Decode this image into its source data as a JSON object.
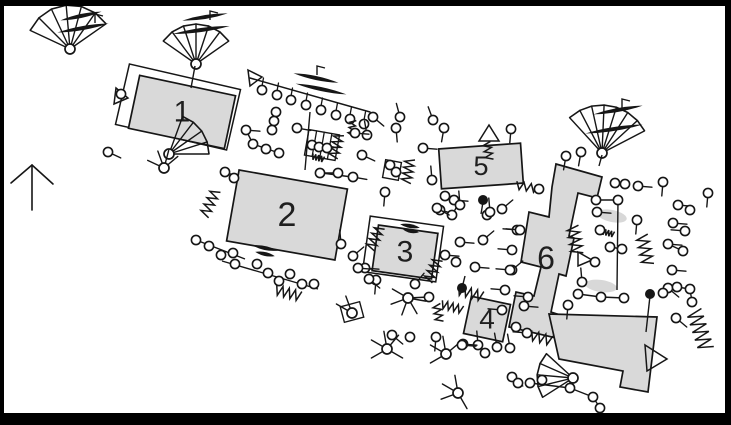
{
  "figure": {
    "kind": "archaeological-site-plan",
    "background": "#ffffff",
    "line_color": "#161616",
    "building_fill": "#d9d9d9",
    "building_stroke": "#161616",
    "blob_fill": "#d6d6d6",
    "frame_color": "#000000",
    "width": 731,
    "height": 425
  },
  "buildings": [
    {
      "label": "1",
      "cx": 182,
      "cy": 112,
      "w": 98,
      "h": 54,
      "rot": 12,
      "fs": 30
    },
    {
      "label": "2",
      "cx": 287,
      "cy": 215,
      "w": 110,
      "h": 72,
      "rot": 10,
      "fs": 34
    },
    {
      "label": "3",
      "cx": 405,
      "cy": 252,
      "w": 60,
      "h": 46,
      "rot": 8,
      "fs": 30
    },
    {
      "label": "4",
      "cx": 487,
      "cy": 319,
      "w": 40,
      "h": 38,
      "rot": 12,
      "fs": 28
    },
    {
      "label": "5",
      "cx": 481,
      "cy": 166,
      "w": 82,
      "h": 40,
      "rot": -4,
      "fs": 27
    }
  ],
  "building6": {
    "label": "6",
    "label_x": 546,
    "label_y": 258,
    "fs": 32,
    "strip": [
      [
        556,
        164
      ],
      [
        602,
        177
      ],
      [
        597,
        198
      ],
      [
        578,
        193
      ],
      [
        569,
        236
      ],
      [
        574,
        238
      ],
      [
        566,
        276
      ],
      [
        559,
        274
      ],
      [
        551,
        312
      ],
      [
        560,
        315
      ],
      [
        556,
        338
      ],
      [
        509,
        327
      ],
      [
        516,
        292
      ],
      [
        534,
        296
      ],
      [
        541,
        267
      ],
      [
        521,
        262
      ],
      [
        529,
        212
      ],
      [
        549,
        217
      ],
      [
        552,
        187
      ]
    ],
    "annex": [
      [
        549,
        314
      ],
      [
        657,
        317
      ],
      [
        648,
        392
      ],
      [
        620,
        387
      ],
      [
        623,
        371
      ],
      [
        559,
        359
      ]
    ]
  },
  "outlines": [
    {
      "cx": 178,
      "cy": 107,
      "w": 114,
      "h": 62,
      "rot": 13
    },
    {
      "cx": 403,
      "cy": 249,
      "w": 74,
      "h": 56,
      "rot": 8
    }
  ],
  "north_arrow": {
    "shaft": [
      [
        32,
        210
      ],
      [
        32,
        165
      ]
    ],
    "barbs": [
      [
        [
          32,
          165
        ],
        [
          11,
          183
        ]
      ],
      [
        [
          32,
          165
        ],
        [
          53,
          184
        ]
      ]
    ]
  },
  "fence": {
    "rail": [
      [
        250,
        78
      ],
      [
        370,
        112
      ]
    ],
    "circles": [
      [
        262,
        90
      ],
      [
        277,
        95
      ],
      [
        291,
        100
      ],
      [
        306,
        105
      ],
      [
        321,
        110
      ],
      [
        336,
        115
      ],
      [
        350,
        119
      ],
      [
        364,
        124
      ]
    ]
  },
  "trees": [
    {
      "x": 70,
      "y": 49,
      "dir": -95,
      "spread": 120,
      "r": 44,
      "n": 7
    },
    {
      "x": 196,
      "y": 64,
      "dir": -90,
      "spread": 110,
      "r": 40,
      "n": 7
    },
    {
      "x": 602,
      "y": 153,
      "dir": -80,
      "spread": 105,
      "r": 48,
      "n": 8
    },
    {
      "x": 573,
      "y": 378,
      "dir": 185,
      "spread": 75,
      "r": 36,
      "n": 5
    },
    {
      "x": 169,
      "y": 154,
      "dir": -35,
      "spread": 70,
      "r": 40,
      "n": 5
    }
  ],
  "blades": [
    [
      83,
      28,
      -10,
      52
    ],
    [
      81,
      16,
      -12,
      42
    ],
    [
      201,
      30,
      -8,
      58
    ],
    [
      205,
      17,
      -9,
      46
    ],
    [
      316,
      78,
      12,
      46
    ],
    [
      321,
      89,
      12,
      52
    ],
    [
      614,
      129,
      -9,
      58
    ],
    [
      618,
      110,
      -10,
      50
    ],
    [
      265,
      248,
      12,
      26
    ],
    [
      265,
      254,
      12,
      20
    ],
    [
      410,
      226,
      10,
      20
    ],
    [
      411,
      231,
      10,
      16
    ]
  ],
  "flags": [
    [
      95,
      14
    ],
    [
      210,
      11
    ],
    [
      317,
      66
    ],
    [
      622,
      99
    ]
  ],
  "triangles": [
    [
      [
        248,
        70
      ],
      [
        262,
        77
      ],
      [
        250,
        86
      ]
    ],
    [
      [
        479,
        141
      ],
      [
        499,
        141
      ],
      [
        489,
        125
      ]
    ],
    [
      [
        645,
        345
      ],
      [
        667,
        359
      ],
      [
        647,
        371
      ]
    ],
    [
      [
        116,
        88
      ],
      [
        128,
        98
      ],
      [
        114,
        104
      ]
    ],
    [
      [
        578,
        252
      ],
      [
        578,
        266
      ],
      [
        592,
        260
      ]
    ]
  ],
  "squares": [
    [
      392,
      170,
      16,
      18,
      10
    ],
    [
      352,
      312,
      20,
      16,
      -15
    ]
  ],
  "ladders": [
    [
      322,
      145,
      31,
      26,
      10
    ]
  ],
  "zigzags": [
    [
      210,
      203,
      115,
      14,
      5,
      4
    ],
    [
      336,
      146,
      105,
      12,
      5,
      4
    ],
    [
      408,
      171,
      100,
      12,
      5,
      4
    ],
    [
      375,
      238,
      115,
      12,
      5,
      4
    ],
    [
      433,
      270,
      115,
      12,
      5,
      4
    ],
    [
      470,
      293,
      15,
      13,
      5,
      4
    ],
    [
      452,
      307,
      15,
      11,
      4,
      4
    ],
    [
      438,
      313,
      80,
      9,
      4,
      3
    ],
    [
      527,
      187,
      10,
      11,
      4,
      3
    ],
    [
      575,
      240,
      80,
      14,
      6,
      4
    ],
    [
      645,
      250,
      78,
      15,
      6,
      4
    ],
    [
      700,
      330,
      72,
      20,
      8,
      5
    ],
    [
      288,
      293,
      15,
      13,
      5,
      4
    ],
    [
      541,
      338,
      15,
      11,
      5,
      3
    ],
    [
      318,
      158,
      15,
      6,
      3,
      4
    ],
    [
      608,
      233,
      15,
      6,
      3,
      4
    ],
    [
      488,
      151,
      80,
      9,
      4,
      3
    ],
    [
      352,
      128,
      100,
      8,
      3,
      3
    ]
  ],
  "spiders": [
    {
      "x": 164,
      "y": 168,
      "legs": [
        205,
        250,
        285,
        320
      ]
    },
    {
      "x": 408,
      "y": 298,
      "legs": [
        10,
        60,
        110,
        160,
        210
      ]
    },
    {
      "x": 352,
      "y": 313,
      "legs": [
        210,
        250
      ]
    },
    {
      "x": 387,
      "y": 349,
      "legs": [
        30,
        150,
        210,
        260,
        310
      ]
    },
    {
      "x": 446,
      "y": 354,
      "legs": [
        150,
        210,
        260,
        320
      ]
    },
    {
      "x": 458,
      "y": 393,
      "legs": [
        60,
        160,
        210,
        260
      ]
    }
  ],
  "dots": [
    [
      483,
      200
    ],
    [
      462,
      288
    ],
    [
      650,
      294
    ]
  ],
  "blobs": [
    [
      612,
      216,
      15,
      6,
      12
    ],
    [
      601,
      286,
      16,
      6,
      8
    ]
  ],
  "chains": [
    [
      [
        246,
        130
      ],
      [
        253,
        144
      ],
      [
        279,
        153
      ]
    ],
    [
      [
        276,
        108
      ],
      [
        271,
        134
      ]
    ],
    [
      [
        310,
        112
      ],
      [
        305,
        170
      ]
    ],
    [
      [
        196,
        240
      ],
      [
        245,
        259
      ]
    ],
    [
      [
        222,
        261
      ],
      [
        318,
        289
      ]
    ],
    [
      [
        322,
        173
      ],
      [
        352,
        177
      ]
    ],
    [
      [
        596,
        200
      ],
      [
        618,
        200
      ],
      [
        617,
        290
      ]
    ],
    [
      [
        610,
        247
      ],
      [
        622,
        249
      ]
    ],
    [
      [
        578,
        294
      ],
      [
        601,
        297
      ],
      [
        624,
        298
      ]
    ],
    [
      [
        663,
        293
      ],
      [
        677,
        287
      ],
      [
        690,
        289
      ],
      [
        692,
        302
      ]
    ],
    [
      [
        668,
        244
      ],
      [
        683,
        251
      ]
    ],
    [
      [
        530,
        383
      ],
      [
        570,
        388
      ],
      [
        593,
        397
      ],
      [
        600,
        408
      ]
    ],
    [
      [
        408,
        298
      ],
      [
        429,
        297
      ]
    ],
    [
      [
        602,
        155
      ],
      [
        599,
        166
      ]
    ],
    [
      [
        195,
        66
      ],
      [
        191,
        88
      ]
    ],
    [
      [
        650,
        296
      ],
      [
        646,
        332
      ]
    ],
    [
      [
        483,
        202
      ],
      [
        481,
        214
      ]
    ],
    [
      [
        462,
        288
      ],
      [
        465,
        276
      ]
    ]
  ],
  "pins": [
    [
      108,
      152,
      25
    ],
    [
      121,
      94,
      null
    ],
    [
      246,
      130,
      5
    ],
    [
      276,
      112,
      null
    ],
    [
      274,
      121,
      null
    ],
    [
      272,
      130,
      null
    ],
    [
      253,
      144,
      null
    ],
    [
      266,
      149,
      null
    ],
    [
      279,
      153,
      null
    ],
    [
      297,
      128,
      10
    ],
    [
      225,
      172,
      20
    ],
    [
      234,
      178,
      null
    ],
    [
      312,
      145,
      null
    ],
    [
      319,
      147,
      null
    ],
    [
      327,
      148,
      null
    ],
    [
      320,
      173,
      0
    ],
    [
      338,
      173,
      null
    ],
    [
      353,
      177,
      10
    ],
    [
      362,
      155,
      25
    ],
    [
      367,
      135,
      260
    ],
    [
      385,
      192,
      95
    ],
    [
      390,
      165,
      null
    ],
    [
      396,
      172,
      null
    ],
    [
      423,
      148,
      5
    ],
    [
      433,
      120,
      250
    ],
    [
      400,
      117,
      255
    ],
    [
      396,
      128,
      85
    ],
    [
      373,
      117,
      40
    ],
    [
      355,
      133,
      5
    ],
    [
      432,
      180,
      265
    ],
    [
      444,
      128,
      100
    ],
    [
      511,
      129,
      95
    ],
    [
      539,
      189,
      null
    ],
    [
      445,
      196,
      40
    ],
    [
      454,
      200,
      5
    ],
    [
      440,
      210,
      15
    ],
    [
      452,
      215,
      300
    ],
    [
      487,
      215,
      null
    ],
    [
      502,
      209,
      320
    ],
    [
      437,
      208,
      30
    ],
    [
      460,
      205,
      265
    ],
    [
      490,
      212,
      265
    ],
    [
      460,
      242,
      5
    ],
    [
      483,
      240,
      320
    ],
    [
      445,
      255,
      5
    ],
    [
      456,
      262,
      null
    ],
    [
      475,
      267,
      5
    ],
    [
      512,
      270,
      320
    ],
    [
      517,
      230,
      185
    ],
    [
      429,
      297,
      null
    ],
    [
      415,
      284,
      310
    ],
    [
      365,
      268,
      5
    ],
    [
      376,
      280,
      95
    ],
    [
      341,
      244,
      265
    ],
    [
      353,
      256,
      320
    ],
    [
      358,
      268,
      5
    ],
    [
      369,
      279,
      40
    ],
    [
      196,
      240,
      null
    ],
    [
      209,
      246,
      null
    ],
    [
      221,
      255,
      null
    ],
    [
      233,
      253,
      null
    ],
    [
      235,
      264,
      null
    ],
    [
      257,
      264,
      null
    ],
    [
      268,
      273,
      null
    ],
    [
      279,
      281,
      null
    ],
    [
      290,
      274,
      null
    ],
    [
      302,
      284,
      null
    ],
    [
      314,
      284,
      null
    ],
    [
      478,
      345,
      265
    ],
    [
      497,
      347,
      260
    ],
    [
      463,
      344,
      5
    ],
    [
      516,
      327,
      null
    ],
    [
      527,
      333,
      185
    ],
    [
      524,
      306,
      5
    ],
    [
      520,
      230,
      185
    ],
    [
      512,
      250,
      185
    ],
    [
      510,
      270,
      185
    ],
    [
      505,
      290,
      185
    ],
    [
      502,
      310,
      185
    ],
    [
      566,
      156,
      100
    ],
    [
      581,
      152,
      100
    ],
    [
      615,
      183,
      5
    ],
    [
      625,
      184,
      null
    ],
    [
      638,
      186,
      5
    ],
    [
      663,
      182,
      95
    ],
    [
      678,
      205,
      5
    ],
    [
      690,
      210,
      null
    ],
    [
      708,
      193,
      95
    ],
    [
      596,
      200,
      null
    ],
    [
      618,
      200,
      null
    ],
    [
      637,
      220,
      95
    ],
    [
      597,
      212,
      5
    ],
    [
      600,
      230,
      null
    ],
    [
      610,
      247,
      null
    ],
    [
      622,
      249,
      null
    ],
    [
      582,
      282,
      265
    ],
    [
      578,
      294,
      null
    ],
    [
      601,
      297,
      null
    ],
    [
      624,
      298,
      null
    ],
    [
      595,
      262,
      null
    ],
    [
      673,
      223,
      5
    ],
    [
      685,
      231,
      185
    ],
    [
      668,
      244,
      5
    ],
    [
      683,
      251,
      null
    ],
    [
      672,
      270,
      5
    ],
    [
      668,
      288,
      40
    ],
    [
      663,
      293,
      null
    ],
    [
      677,
      287,
      null
    ],
    [
      690,
      289,
      null
    ],
    [
      692,
      302,
      null
    ],
    [
      676,
      318,
      40
    ],
    [
      392,
      335,
      40
    ],
    [
      410,
      337,
      null
    ],
    [
      436,
      337,
      95
    ],
    [
      462,
      345,
      5
    ],
    [
      485,
      353,
      null
    ],
    [
      510,
      348,
      260
    ],
    [
      512,
      377,
      40
    ],
    [
      518,
      383,
      null
    ],
    [
      530,
      383,
      null
    ],
    [
      542,
      380,
      null
    ],
    [
      570,
      388,
      null
    ],
    [
      593,
      397,
      null
    ],
    [
      600,
      408,
      null
    ],
    [
      528,
      297,
      185
    ],
    [
      568,
      305,
      95
    ]
  ],
  "frame": {
    "top": [
      0,
      0,
      731,
      6
    ],
    "bottom": [
      0,
      413,
      731,
      12
    ],
    "left": [
      0,
      0,
      4,
      425
    ],
    "right": [
      725,
      0,
      6,
      425
    ]
  }
}
